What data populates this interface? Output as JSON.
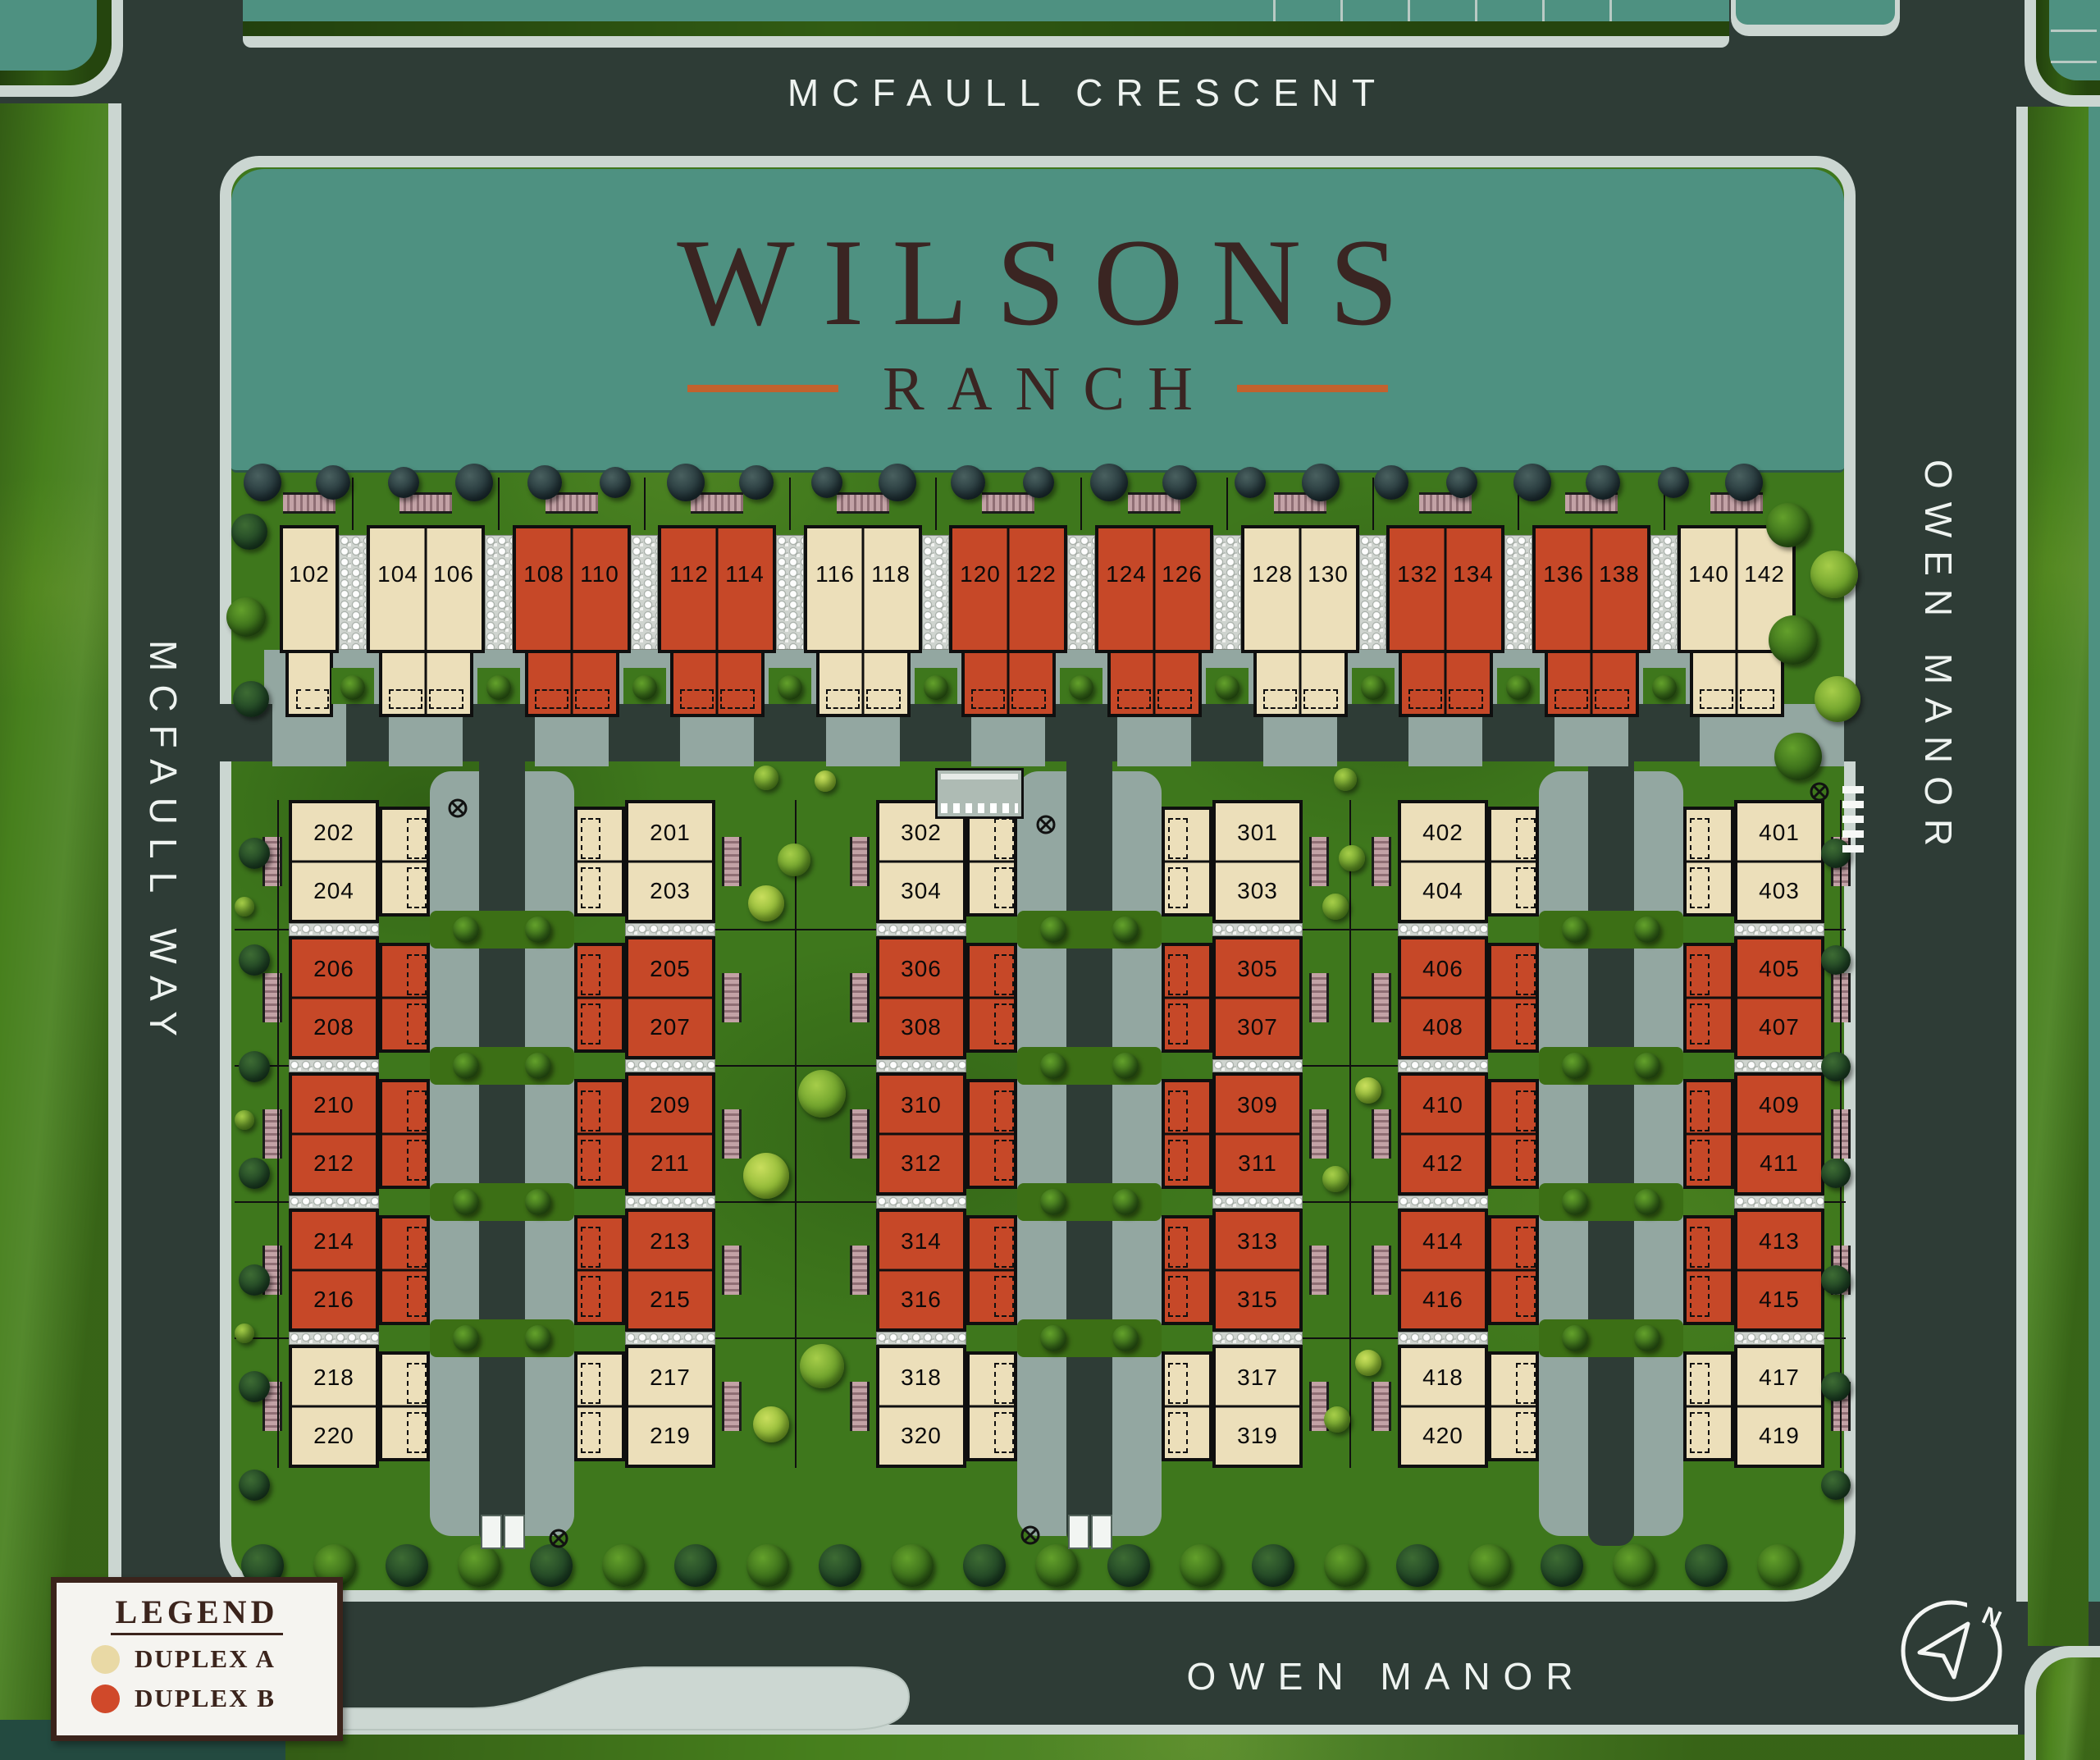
{
  "title": {
    "main": "WILSONS",
    "sub": "RANCH"
  },
  "streets": {
    "top": "MCFAULL CRESCENT",
    "left": "MCFAULL WAY",
    "right": "OWEN MANOR",
    "bottom": "OWEN MANOR"
  },
  "legend": {
    "title": "LEGEND",
    "items": [
      {
        "label": "DUPLEX A",
        "color": "#e9d9a5",
        "type": "A"
      },
      {
        "label": "DUPLEX B",
        "color": "#d0492a",
        "type": "B"
      }
    ]
  },
  "compass": {
    "label": "N"
  },
  "colors": {
    "duplex_a": "#ecdfba",
    "duplex_b": "#c64828",
    "teal": "#4e9181",
    "road": "#2e3c36",
    "sidewalk": "#cbd6d1",
    "apron": "#93a7a1",
    "grass": "#3e771c",
    "title_brown": "#3a2522",
    "accent_orange": "#c2622e",
    "bench": "#b89aa0"
  },
  "top_row": [
    {
      "type": "A",
      "units": [
        "102"
      ]
    },
    {
      "type": "A",
      "units": [
        "104",
        "106"
      ]
    },
    {
      "type": "B",
      "units": [
        "108",
        "110"
      ]
    },
    {
      "type": "B",
      "units": [
        "112",
        "114"
      ]
    },
    {
      "type": "A",
      "units": [
        "116",
        "118"
      ]
    },
    {
      "type": "B",
      "units": [
        "120",
        "122"
      ]
    },
    {
      "type": "B",
      "units": [
        "124",
        "126"
      ]
    },
    {
      "type": "A",
      "units": [
        "128",
        "130"
      ]
    },
    {
      "type": "B",
      "units": [
        "132",
        "134"
      ]
    },
    {
      "type": "B",
      "units": [
        "136",
        "138"
      ]
    },
    {
      "type": "A",
      "units": [
        "140",
        "142"
      ]
    }
  ],
  "columns": [
    {
      "name": "column-200-west",
      "front_side": "left",
      "pairs": [
        {
          "type": "A",
          "units": [
            "202",
            "204"
          ]
        },
        {
          "type": "B",
          "units": [
            "206",
            "208"
          ]
        },
        {
          "type": "B",
          "units": [
            "210",
            "212"
          ]
        },
        {
          "type": "B",
          "units": [
            "214",
            "216"
          ]
        },
        {
          "type": "A",
          "units": [
            "218",
            "220"
          ]
        }
      ]
    },
    {
      "name": "column-200-east",
      "front_side": "right",
      "pairs": [
        {
          "type": "A",
          "units": [
            "201",
            "203"
          ]
        },
        {
          "type": "B",
          "units": [
            "205",
            "207"
          ]
        },
        {
          "type": "B",
          "units": [
            "209",
            "211"
          ]
        },
        {
          "type": "B",
          "units": [
            "213",
            "215"
          ]
        },
        {
          "type": "A",
          "units": [
            "217",
            "219"
          ]
        }
      ]
    },
    {
      "name": "column-300-west",
      "front_side": "left",
      "pairs": [
        {
          "type": "A",
          "units": [
            "302",
            "304"
          ]
        },
        {
          "type": "B",
          "units": [
            "306",
            "308"
          ]
        },
        {
          "type": "B",
          "units": [
            "310",
            "312"
          ]
        },
        {
          "type": "B",
          "units": [
            "314",
            "316"
          ]
        },
        {
          "type": "A",
          "units": [
            "318",
            "320"
          ]
        }
      ]
    },
    {
      "name": "column-300-east",
      "front_side": "right",
      "pairs": [
        {
          "type": "A",
          "units": [
            "301",
            "303"
          ]
        },
        {
          "type": "B",
          "units": [
            "305",
            "307"
          ]
        },
        {
          "type": "B",
          "units": [
            "309",
            "311"
          ]
        },
        {
          "type": "B",
          "units": [
            "313",
            "315"
          ]
        },
        {
          "type": "A",
          "units": [
            "317",
            "319"
          ]
        }
      ]
    },
    {
      "name": "column-400-west",
      "front_side": "left",
      "pairs": [
        {
          "type": "A",
          "units": [
            "402",
            "404"
          ]
        },
        {
          "type": "B",
          "units": [
            "406",
            "408"
          ]
        },
        {
          "type": "B",
          "units": [
            "410",
            "412"
          ]
        },
        {
          "type": "B",
          "units": [
            "414",
            "416"
          ]
        },
        {
          "type": "A",
          "units": [
            "418",
            "420"
          ]
        }
      ]
    },
    {
      "name": "column-400-east",
      "front_side": "right",
      "pairs": [
        {
          "type": "A",
          "units": [
            "401",
            "403"
          ]
        },
        {
          "type": "B",
          "units": [
            "405",
            "407"
          ]
        },
        {
          "type": "B",
          "units": [
            "409",
            "411"
          ]
        },
        {
          "type": "B",
          "units": [
            "413",
            "415"
          ]
        },
        {
          "type": "A",
          "units": [
            "417",
            "419"
          ]
        }
      ]
    }
  ]
}
